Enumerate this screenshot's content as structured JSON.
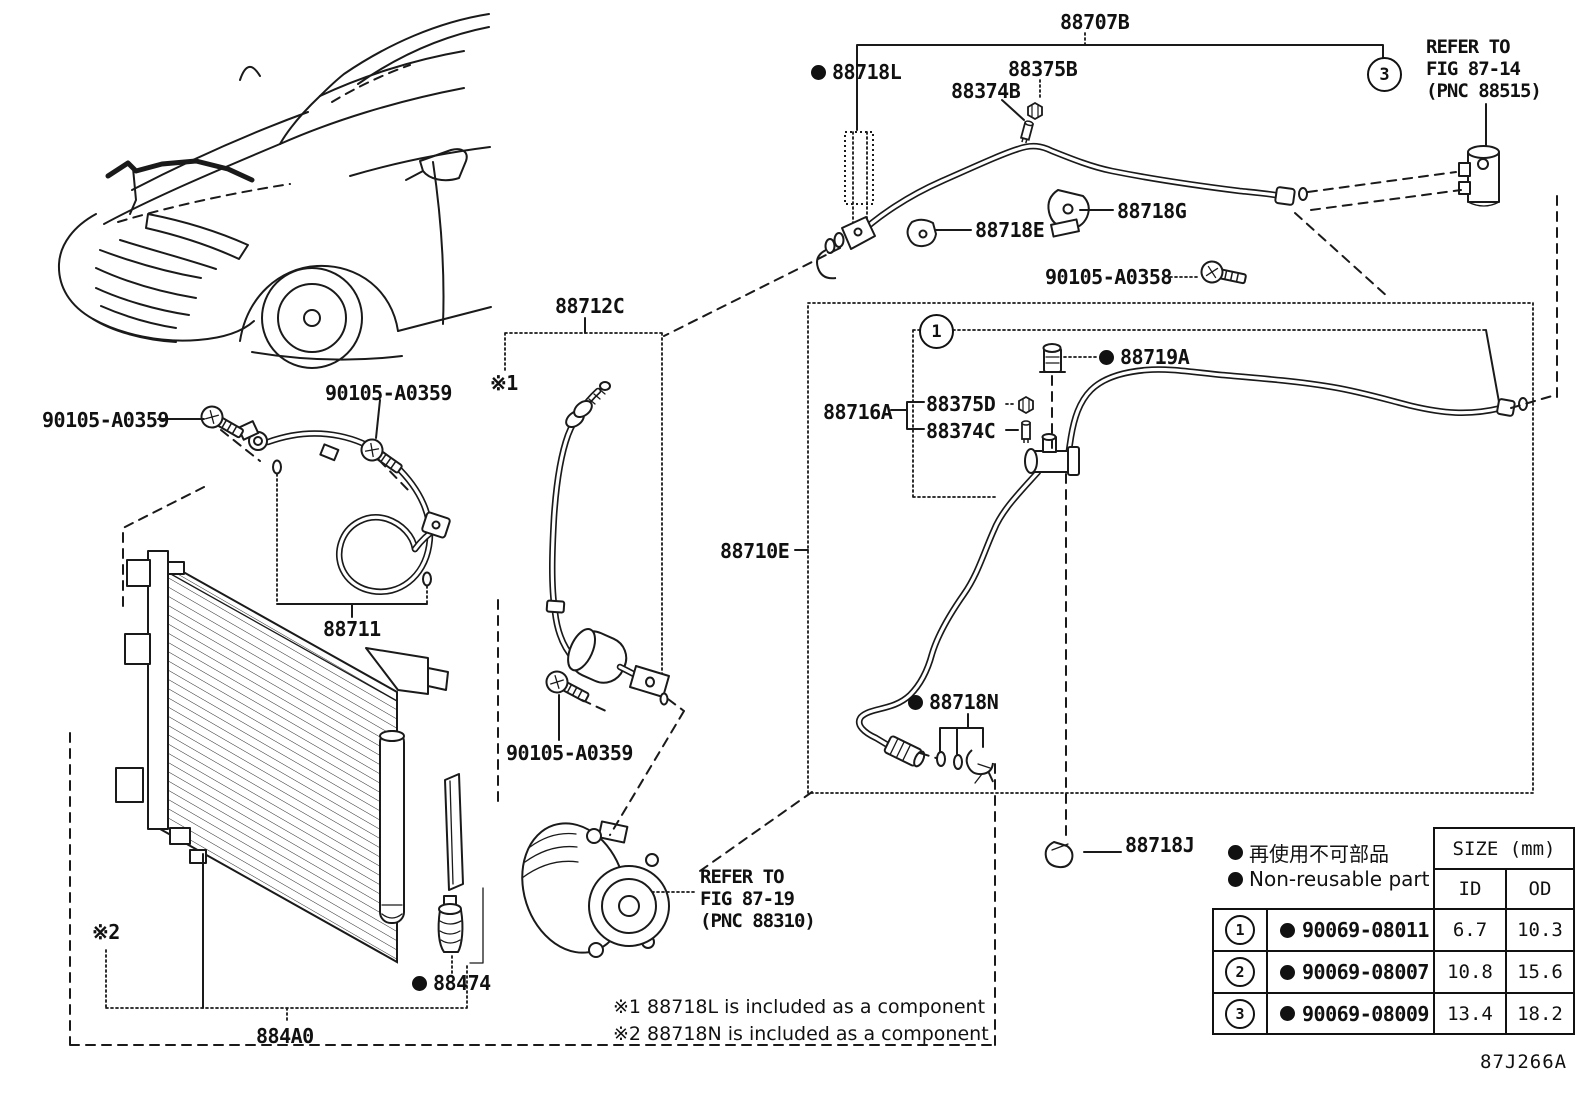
{
  "labels": {
    "l88707b": "88707B",
    "l88718l": "88718L",
    "l88375b": "88375B",
    "l88374b": "88374B",
    "l88718e": "88718E",
    "l88718g": "88718G",
    "l90105a0358": "90105-A0358",
    "l88712c": "88712C",
    "l88711": "88711",
    "l90105a0359_left": "90105-A0359",
    "l90105a0359_mid": "90105-A0359",
    "l90105a0359_low": "90105-A0359",
    "l88710e": "88710E",
    "l88716a": "88716A",
    "l88375d": "88375D",
    "l88374c": "88374C",
    "l88719a": "88719A",
    "l88718n": "88718N",
    "l88718j": "88718J",
    "l88474": "88474",
    "l884a0": "884A0"
  },
  "markers": {
    "note1": "※1",
    "note2": "※2"
  },
  "callouts": {
    "c1": "1",
    "c3": "3"
  },
  "refer_fig_87_14": {
    "line1": "REFER TO",
    "line2": "FIG 87-14",
    "line3": "(PNC 88515)"
  },
  "refer_fig_87_19": {
    "line1": "REFER TO",
    "line2": "FIG 87-19",
    "line3": "(PNC 88310)"
  },
  "legend": {
    "jp": "再使用不可部品",
    "en": "Non-reusable part"
  },
  "footnotes": {
    "note1": "※1 88718L is included as a component",
    "note2": "※2 88718N is included as a component"
  },
  "size_table": {
    "header": "SIZE (mm)",
    "id": "ID",
    "od": "OD",
    "rows": [
      {
        "no": "1",
        "part": "90069-08011",
        "id": "6.7",
        "od": "10.3"
      },
      {
        "no": "2",
        "part": "90069-08007",
        "id": "10.8",
        "od": "15.6"
      },
      {
        "no": "3",
        "part": "90069-08009",
        "id": "13.4",
        "od": "18.2"
      }
    ]
  },
  "diagram_code": "87J266A",
  "colors": {
    "line": "#1a1a1a",
    "background": "#ffffff"
  }
}
